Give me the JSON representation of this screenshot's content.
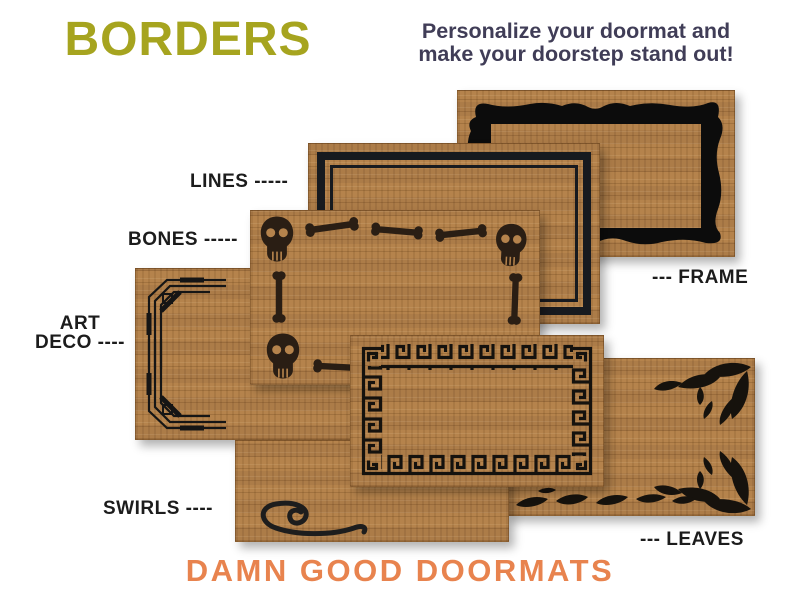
{
  "header": {
    "title": "BORDERS",
    "title_color": "#a6a41f",
    "subtitle_line1": "Personalize your doormat and",
    "subtitle_line2": "make your doorstep stand out!",
    "subtitle_color": "#403d57"
  },
  "labels": {
    "lines": "LINES -----",
    "bones": "BONES -----",
    "artdeco_line1": "ART",
    "artdeco_line2": "DECO ----",
    "frame": "--- FRAME",
    "swirls": "SWIRLS ----",
    "leaves": "--- LEAVES",
    "label_color": "#1c1c1c"
  },
  "mats": {
    "coir_color": "#b5834c",
    "design_color": "#16120d",
    "styles": [
      "frame",
      "lines",
      "bones",
      "art-deco",
      "greek-key",
      "swirls",
      "leaves"
    ]
  },
  "footer": {
    "brand": "DAMN GOOD DOORMATS",
    "brand_color": "#e8834e"
  }
}
